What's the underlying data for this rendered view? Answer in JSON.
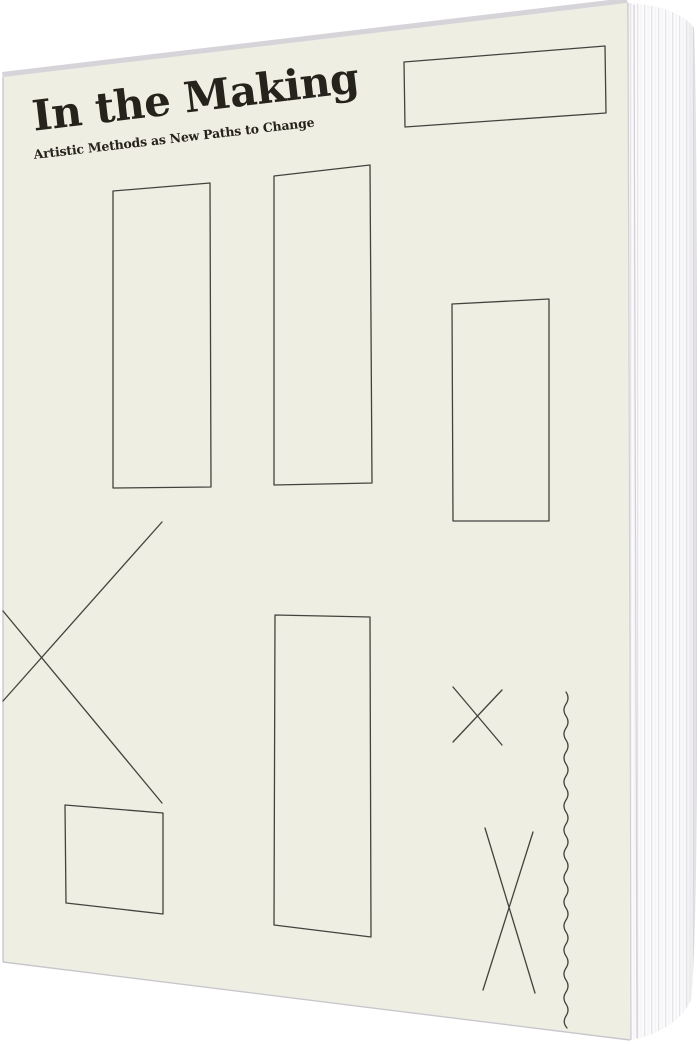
{
  "scene": {
    "description": "Product photo of a standing softcover book viewed at a slight angle, white page edges visible along the right side, on a plain white background"
  },
  "book": {
    "title": "In the Making",
    "subtitle": "Artistic Methods as New Paths to Change",
    "artwork": [
      "banner-rectangle-top-right",
      "tall-rectangle-upper-left",
      "tall-rectangle-upper-middle",
      "rectangle-upper-right",
      "large-cross-left",
      "small-square-bottom-left",
      "tall-rectangle-lower-middle",
      "small-cross-right",
      "narrow-tall-cross-bottom-right",
      "wavy-vertical-line"
    ]
  },
  "colors": {
    "background": "#ffffff",
    "cover": "#efeee3",
    "artwork-line": "#45423e",
    "title-text": "#26221c",
    "page-edge": "#fbfbfc",
    "page-stripe": "#e6e4e9",
    "board-edge": "#d6d3d9"
  }
}
